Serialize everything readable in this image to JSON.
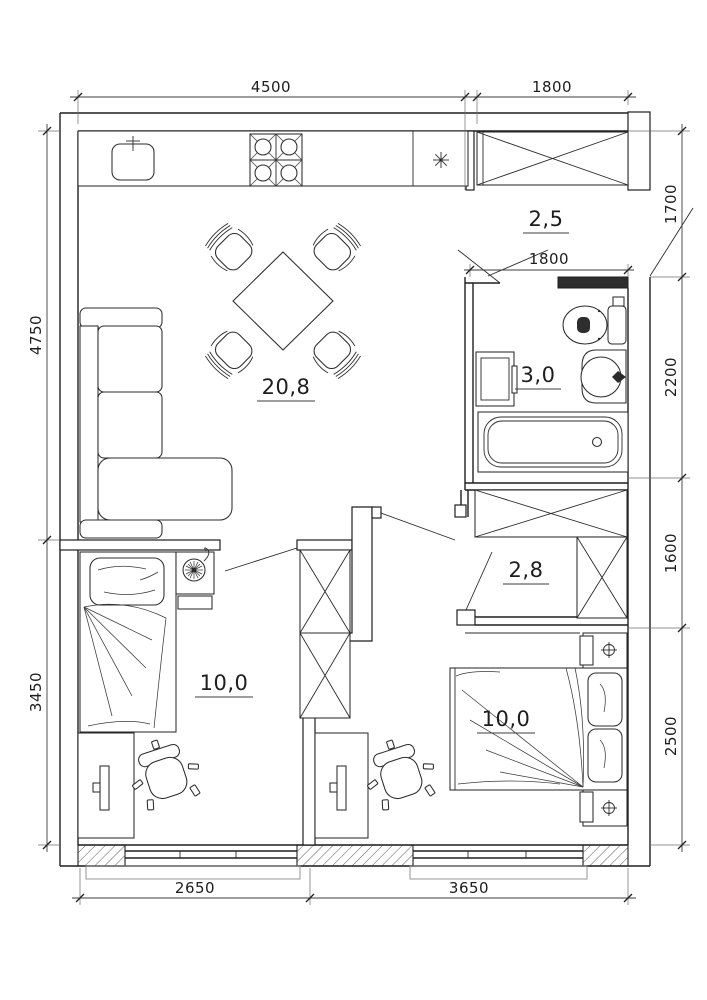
{
  "floor_plan": {
    "type": "apartment-floor-plan",
    "units": "mm",
    "rooms": [
      {
        "name": "living-room-kitchen",
        "area": "20,8"
      },
      {
        "name": "corridor-top",
        "area": "2,5"
      },
      {
        "name": "bathroom",
        "area": "3,0"
      },
      {
        "name": "hallway",
        "area": "2,8"
      },
      {
        "name": "bedroom-left",
        "area": "10,0"
      },
      {
        "name": "bedroom-right",
        "area": "10,0"
      }
    ],
    "dimensions_mm": {
      "top": [
        "4500",
        "1800"
      ],
      "right": [
        "1700",
        "2200",
        "1600",
        "2500"
      ],
      "left": [
        "4750",
        "3450"
      ],
      "bottom": [
        "2650",
        "3650"
      ],
      "bathroom_interior": "1800"
    },
    "fixtures": [
      "kitchen-counter",
      "kitchen-sink",
      "stove-4-burner",
      "vent-asterisk",
      "built-in-wardrobes-x4",
      "dining-table-with-4-chairs",
      "corner-sofa",
      "toilet",
      "washbasin",
      "washing-machine",
      "bathtub",
      "single-bed",
      "double-bed",
      "nightstand-with-lamp",
      "nightstands-with-sconce-x3",
      "desk-with-monitor-x2",
      "office-chair-x2",
      "windows-x2"
    ]
  }
}
